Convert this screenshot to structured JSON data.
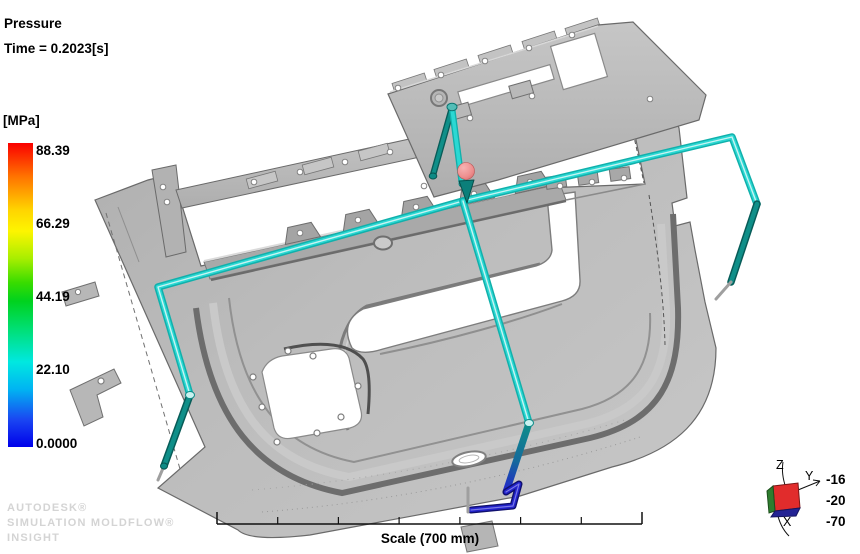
{
  "plot_header": {
    "result_name": "Pressure",
    "time_label": "Time = 0.2023[s]"
  },
  "legend": {
    "unit_label": "[MPa]",
    "tick_labels": [
      "88.39",
      "66.29",
      "44.19",
      "22.10",
      "0.0000"
    ],
    "max_value": 88.39,
    "min_value": 0.0,
    "gradient_top_color": "#fa0000",
    "gradient_bottom_color": "#0000ea"
  },
  "watermark": {
    "lines": [
      "AUTODESK®",
      "SIMULATION MOLDFLOW®",
      "INSIGHT"
    ]
  },
  "scale_bar": {
    "label": "Scale (700 mm)"
  },
  "axis_triad": {
    "z_label": "Z",
    "y_label": "Y",
    "x_label": "X",
    "rotation_values": [
      "-16",
      "-20",
      "-70"
    ]
  },
  "model": {
    "description": "Car door trim panel with feed-system runners highlighted",
    "panel_color": "#b5b5b5",
    "runner_color_bright": "#2bd8d3",
    "runner_color_dark": "#0f8f89",
    "runner_color_frozen": "#2222cc",
    "injection_marker_color": "#ee8f8f"
  }
}
